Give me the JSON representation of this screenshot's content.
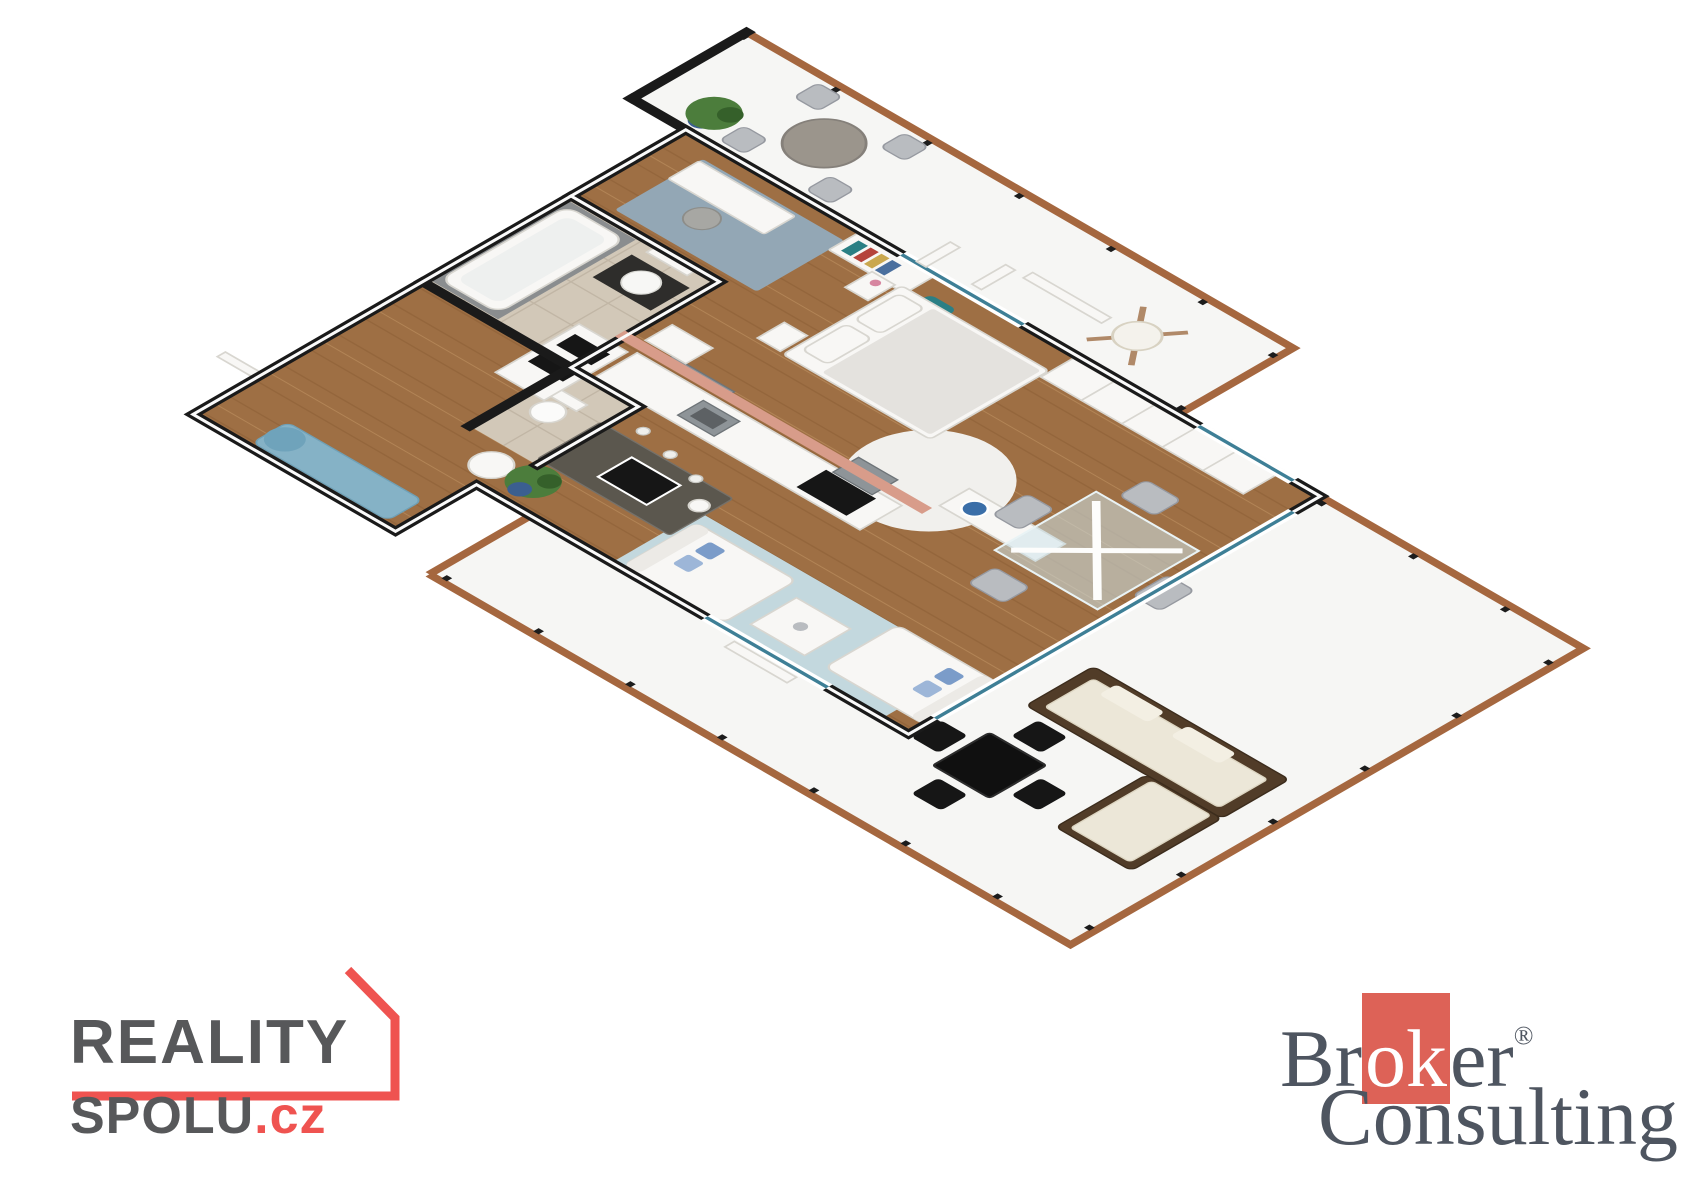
{
  "image_type": "3d-isometric-floor-plan-render",
  "branding": {
    "reality_spolu": {
      "line1": "REALITY",
      "line2": "SPOLU",
      "tld": ".cz",
      "text_color": "#57585a",
      "accent_color": "#ef5350"
    },
    "broker_consulting": {
      "word1_pre": "Br",
      "word1_mid": "ok",
      "word1_post": "er",
      "registered": "®",
      "word2": "Consulting",
      "text_color": "#4e5560",
      "highlight_bg": "#dd6257",
      "highlight_text": "#ffffff"
    }
  },
  "scene": {
    "colors": {
      "wall": "#1a1a1a",
      "wall_cap": "#fafafa",
      "accent_wall": "#d89c8a",
      "terrace": "#f6f6f4",
      "trim": "#a5673f",
      "post": "#1c1c1c",
      "wood": "#9e6f44",
      "wood_line": "#7a4f28",
      "tile": "#d2c8b8",
      "grout": "#b9ae9d",
      "rug_living": "#c3d8de",
      "rug_study": "#93a7b5",
      "rug_round": "#f1f0ed",
      "white_furn": "#f8f7f5",
      "furn_stroke": "#d8d6d0",
      "gray_furn": "#b9bcc0",
      "dark": "#161616",
      "steel": "#8e9498",
      "granite": "#5b574e",
      "glass_frame": "#3e7f96",
      "plant": "#4c7d3c",
      "pot": "#3b5f90",
      "bench": "#85b2c6",
      "teal": "#2b7f85",
      "cushion": "#ece7d8",
      "rattan": "#513c28",
      "pillow_blue": "#7b9cc9",
      "basin_dark": "#2e2d2b",
      "table_gray": "#9b958c"
    },
    "rooms": [
      "balcony-terrace",
      "wraparound-terrace",
      "bedroom",
      "kitchen",
      "living-room",
      "dining-area",
      "bathroom",
      "wc",
      "entry-hall",
      "study-corner"
    ],
    "furniture": [
      "round-patio-table",
      "patio-chairs",
      "potted-plants",
      "hanging-chair",
      "double-bed",
      "nightstands",
      "wardrobe",
      "kitchen-island",
      "oven-tower",
      "kitchen-counter",
      "range-hood",
      "two-white-sofas",
      "coffee-table",
      "glass-dining-table",
      "gray-dining-chairs",
      "sideboard",
      "bathtub",
      "vanity-basin",
      "toilet",
      "blue-bench",
      "rattan-corner-sofa",
      "black-outdoor-dining-set",
      "bookshelf",
      "desk"
    ]
  }
}
